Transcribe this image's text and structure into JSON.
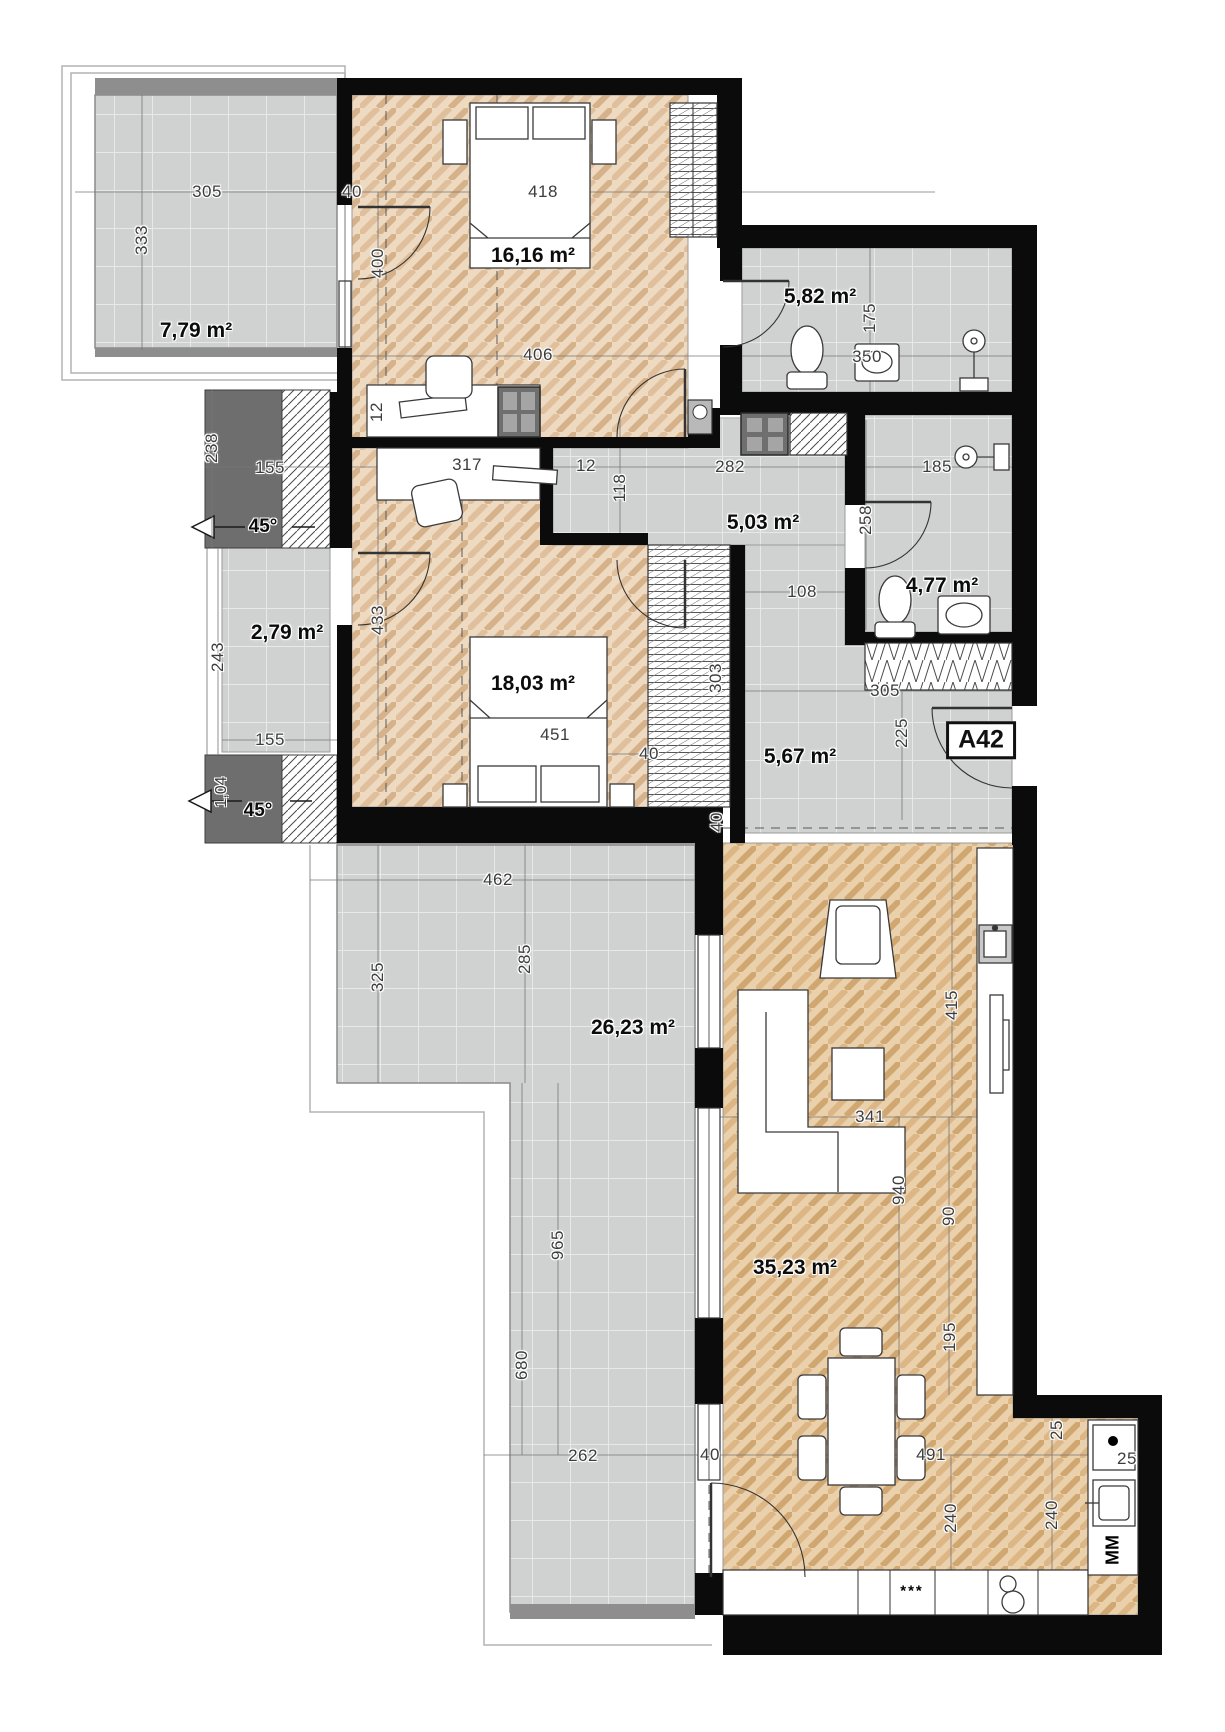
{
  "plan": {
    "unit_label": "A42"
  },
  "rooms": [
    {
      "id": "terrace-top",
      "area_label": "7,79 m²",
      "x": 196,
      "y": 331
    },
    {
      "id": "bedroom-1",
      "area_label": "16,16 m²",
      "x": 533,
      "y": 256
    },
    {
      "id": "bathroom-1",
      "area_label": "5,82 m²",
      "x": 820,
      "y": 297
    },
    {
      "id": "corridor",
      "area_label": "5,03 m²",
      "x": 763,
      "y": 523
    },
    {
      "id": "bathroom-2",
      "area_label": "4,77 m²",
      "x": 942,
      "y": 586
    },
    {
      "id": "storage",
      "area_label": "2,79 m²",
      "x": 287,
      "y": 633
    },
    {
      "id": "bedroom-2",
      "area_label": "18,03 m²",
      "x": 533,
      "y": 684
    },
    {
      "id": "entrance-hall",
      "area_label": "5,67 m²",
      "x": 800,
      "y": 757
    },
    {
      "id": "terrace-large",
      "area_label": "26,23 m²",
      "x": 633,
      "y": 1028
    },
    {
      "id": "living-kitchen",
      "area_label": "35,23 m²",
      "x": 795,
      "y": 1268
    }
  ],
  "labels": {
    "dims": [
      {
        "text": "305",
        "x": 207,
        "y": 192
      },
      {
        "text": "40",
        "x": 352,
        "y": 192
      },
      {
        "text": "418",
        "x": 543,
        "y": 192
      },
      {
        "text": "333",
        "x": 142,
        "y": 240,
        "rot": true
      },
      {
        "text": "400",
        "x": 378,
        "y": 263,
        "rot": true
      },
      {
        "text": "406",
        "x": 538,
        "y": 355
      },
      {
        "text": "175",
        "x": 870,
        "y": 318,
        "rot": true
      },
      {
        "text": "350",
        "x": 867,
        "y": 357
      },
      {
        "text": "12",
        "x": 377,
        "y": 412,
        "rot": true
      },
      {
        "text": "317",
        "x": 467,
        "y": 465
      },
      {
        "text": "12",
        "x": 586,
        "y": 466
      },
      {
        "text": "118",
        "x": 620,
        "y": 488,
        "rot": true
      },
      {
        "text": "282",
        "x": 730,
        "y": 467
      },
      {
        "text": "185",
        "x": 937,
        "y": 467
      },
      {
        "text": "258",
        "x": 866,
        "y": 520,
        "rot": true
      },
      {
        "text": "108",
        "x": 802,
        "y": 592
      },
      {
        "text": "238",
        "x": 212,
        "y": 448,
        "rot": true
      },
      {
        "text": "155",
        "x": 270,
        "y": 468
      },
      {
        "text": "243",
        "x": 218,
        "y": 657,
        "rot": true
      },
      {
        "text": "155",
        "x": 270,
        "y": 740
      },
      {
        "text": "433",
        "x": 378,
        "y": 620,
        "rot": true
      },
      {
        "text": "451",
        "x": 555,
        "y": 735
      },
      {
        "text": "303",
        "x": 716,
        "y": 678,
        "rot": true
      },
      {
        "text": "40",
        "x": 649,
        "y": 754
      },
      {
        "text": "40",
        "x": 717,
        "y": 822,
        "rot": true
      },
      {
        "text": "305",
        "x": 885,
        "y": 691
      },
      {
        "text": "225",
        "x": 902,
        "y": 733,
        "rot": true
      },
      {
        "text": "462",
        "x": 498,
        "y": 880
      },
      {
        "text": "325",
        "x": 378,
        "y": 977,
        "rot": true
      },
      {
        "text": "285",
        "x": 525,
        "y": 959,
        "rot": true
      },
      {
        "text": "415",
        "x": 952,
        "y": 1005,
        "rot": true
      },
      {
        "text": "341",
        "x": 870,
        "y": 1117
      },
      {
        "text": "940",
        "x": 899,
        "y": 1190,
        "rot": true
      },
      {
        "text": "90",
        "x": 949,
        "y": 1216,
        "rot": true
      },
      {
        "text": "195",
        "x": 950,
        "y": 1337,
        "rot": true
      },
      {
        "text": "965",
        "x": 558,
        "y": 1245,
        "rot": true
      },
      {
        "text": "680",
        "x": 522,
        "y": 1365,
        "rot": true
      },
      {
        "text": "262",
        "x": 583,
        "y": 1456
      },
      {
        "text": "40",
        "x": 710,
        "y": 1455
      },
      {
        "text": "491",
        "x": 931,
        "y": 1455
      },
      {
        "text": "240",
        "x": 951,
        "y": 1518,
        "rot": true
      },
      {
        "text": "240",
        "x": 1052,
        "y": 1515,
        "rot": true
      },
      {
        "text": "25",
        "x": 1057,
        "y": 1430,
        "rot": true
      },
      {
        "text": "25",
        "x": 1127,
        "y": 1459
      }
    ],
    "misc": [
      {
        "text": "45°",
        "x": 263,
        "y": 527,
        "cls": "deg"
      },
      {
        "text": "45°",
        "x": 258,
        "y": 811,
        "cls": "deg"
      },
      {
        "text": "1,04",
        "x": 222,
        "y": 792,
        "cls": "dim2",
        "rot": true
      },
      {
        "text": "MM",
        "x": 1113,
        "y": 1550,
        "cls": "mm",
        "rot": true
      },
      {
        "text": "***",
        "x": 912,
        "y": 1591,
        "cls": "stars"
      }
    ]
  },
  "colors": {
    "wall": "#0b0b0b",
    "wood": "#eedac0",
    "wood_living": "#ead0ab",
    "tile": "#cfd2d1",
    "roof_dark": "#6e6e6e",
    "band_gray": "#8e8e8e"
  }
}
